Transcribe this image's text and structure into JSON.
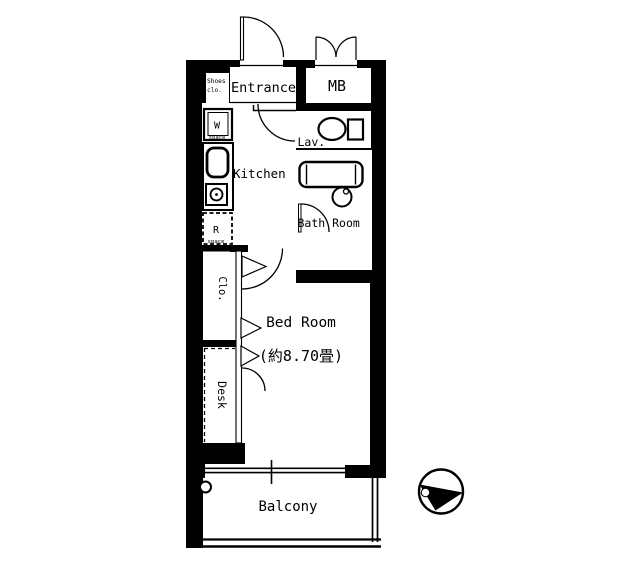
{
  "colors": {
    "line": "#000000",
    "floor": "#ffffff"
  },
  "rooms": {
    "entrance": {
      "label": "Entrance"
    },
    "shoes_closet": {
      "line1": "Shoes",
      "line2": "clo."
    },
    "meter_box": {
      "label": "MB"
    },
    "lavatory": {
      "label": "Lav."
    },
    "kitchen": {
      "label": "Kitchen"
    },
    "bathroom": {
      "label": "Bath Room"
    },
    "closet": {
      "label": "Clo."
    },
    "desk": {
      "label": "Desk"
    },
    "bedroom": {
      "label": "Bed Room",
      "size": "(約8.70畳)"
    },
    "balcony": {
      "label": "Balcony"
    }
  },
  "fixtures": {
    "washer_space": {
      "label": "W",
      "sub": "space"
    },
    "fridge_space": {
      "label": "R",
      "sub": "space"
    }
  }
}
